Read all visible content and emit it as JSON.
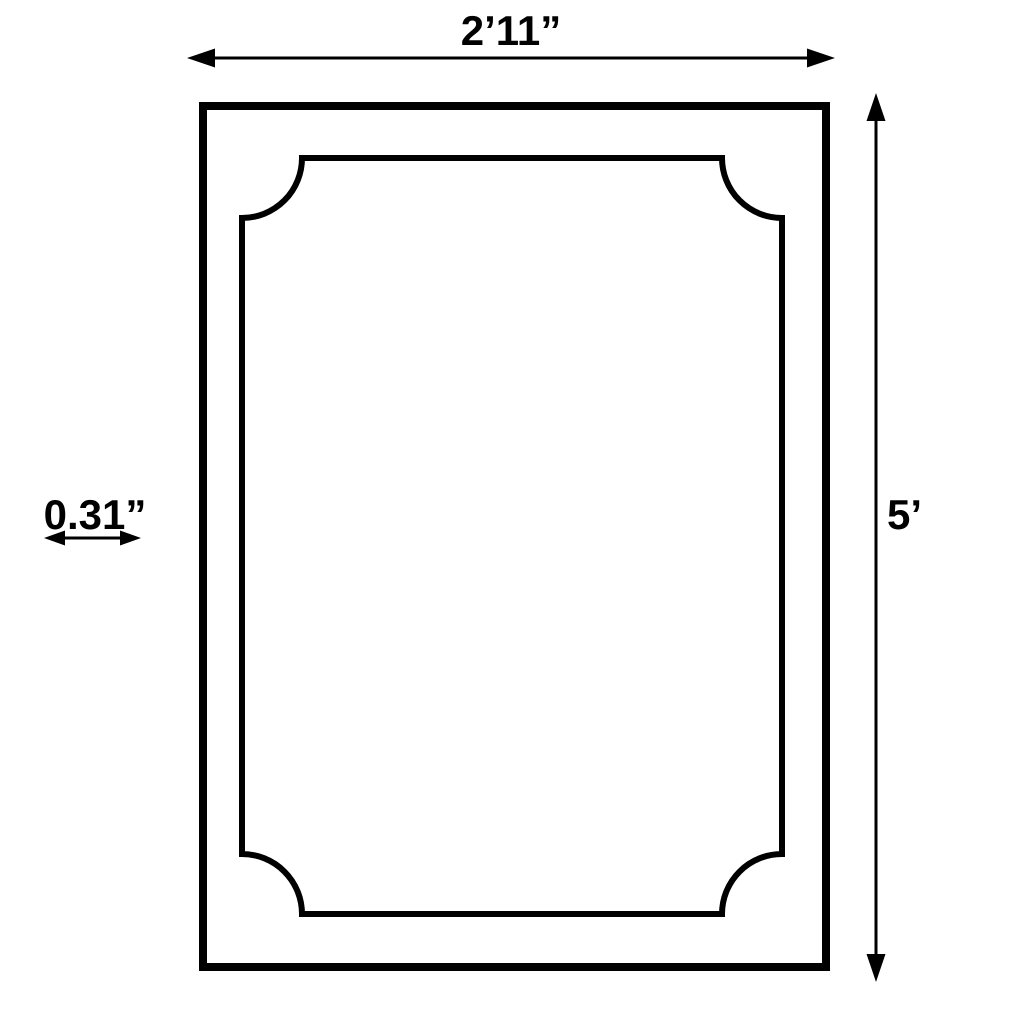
{
  "diagram": {
    "type": "product-dimension-diagram",
    "subject": "rectangular wall panel / frame molding with scooped (concave) corners",
    "colors": {
      "background": "#ffffff",
      "line": "#000000"
    },
    "labels": {
      "width": "2’11”",
      "height": "5’",
      "molding_width": "0.31”"
    },
    "icons": [
      "arrow-left-icon",
      "arrow-right-icon",
      "arrow-up-icon",
      "arrow-down-icon",
      "double-arrow-icon"
    ]
  }
}
